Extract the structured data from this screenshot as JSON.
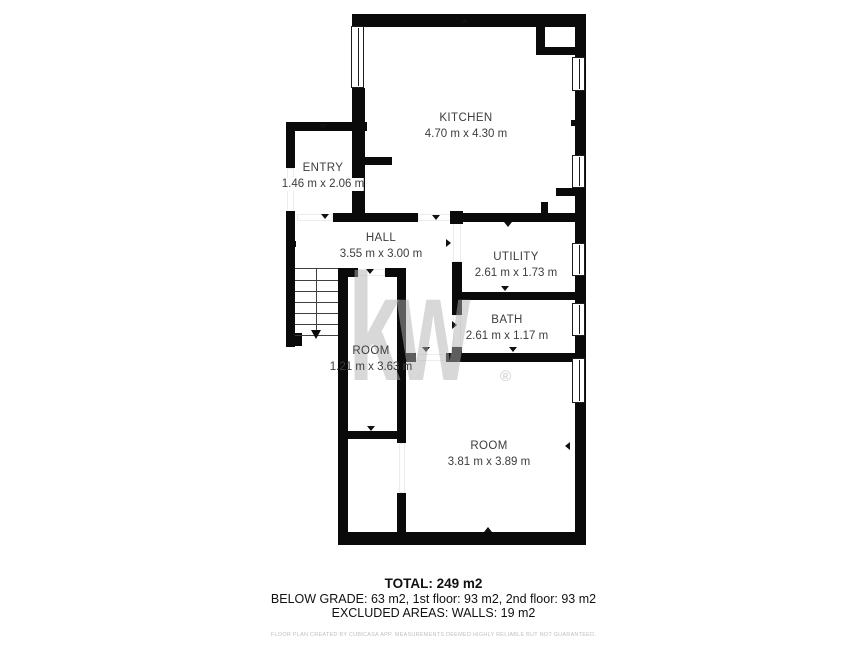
{
  "watermark": {
    "text": "kw",
    "registered": "®"
  },
  "rooms": {
    "kitchen": {
      "name": "KITCHEN",
      "dims": "4.70 m x 4.30 m"
    },
    "entry": {
      "name": "ENTRY",
      "dims": "1.46 m x 2.06 m"
    },
    "hall": {
      "name": "HALL",
      "dims": "3.55 m x 3.00 m"
    },
    "utility": {
      "name": "UTILITY",
      "dims": "2.61 m x 1.73 m"
    },
    "bath": {
      "name": "BATH",
      "dims": "2.61 m x 1.17 m"
    },
    "room_small": {
      "name": "ROOM",
      "dims": "1.21 m x 3.63 m"
    },
    "room_large": {
      "name": "ROOM",
      "dims": "3.81 m x 3.89 m"
    }
  },
  "footer": {
    "total": "TOTAL: 249 m2",
    "breakdown": "BELOW GRADE: 63 m2, 1st floor: 93 m2, 2nd floor: 93 m2",
    "excluded": "EXCLUDED AREAS: WALLS: 19 m2",
    "disclaimer": "FLOOR PLAN CREATED BY CUBICASA APP. MEASUREMENTS DEEMED HIGHLY RELIABLE BUT NOT GUARANTEED."
  }
}
